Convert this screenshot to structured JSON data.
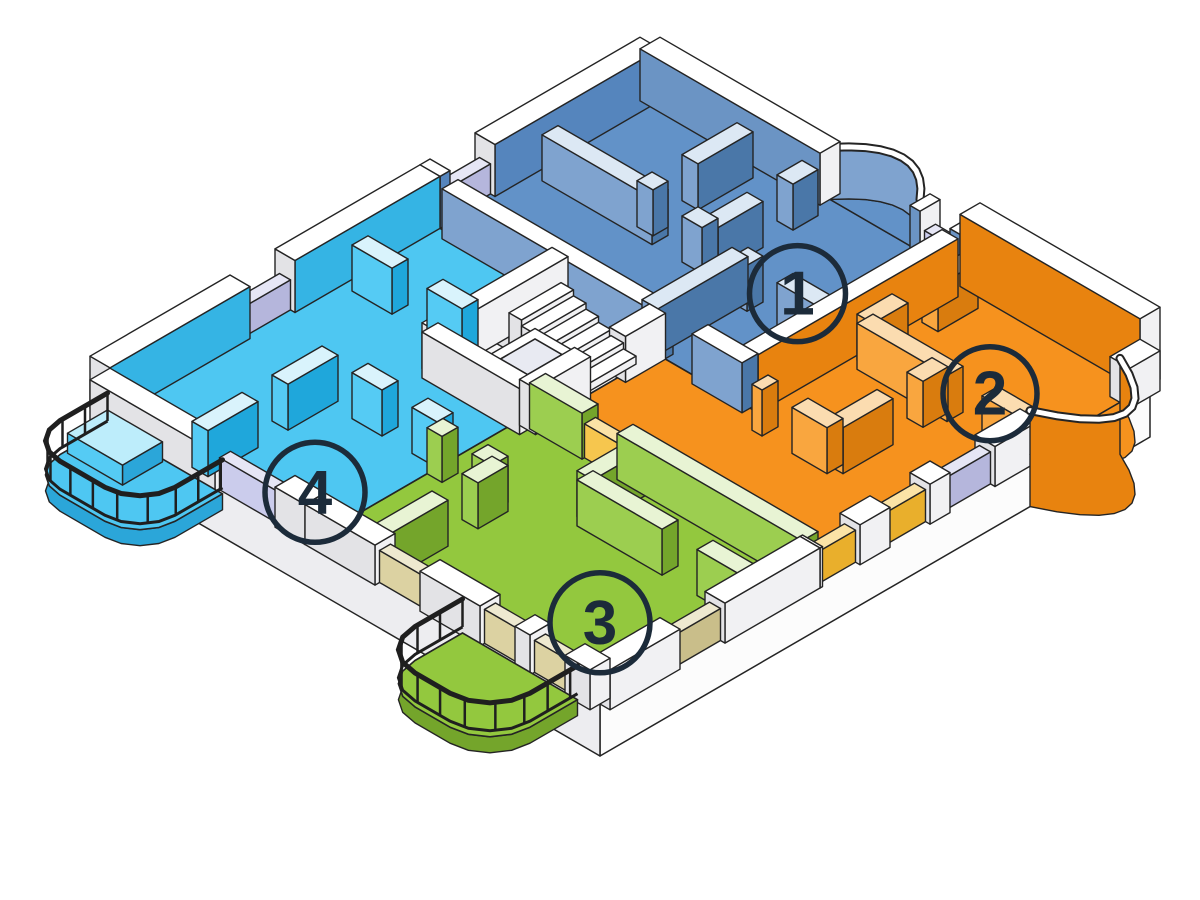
{
  "title": "Isometric cutaway floor plan with four numbered apartments",
  "units": [
    {
      "number": "1",
      "color_hex": "#6292C8",
      "position": "top-center"
    },
    {
      "number": "2",
      "color_hex": "#F6921E",
      "position": "right"
    },
    {
      "number": "3",
      "color_hex": "#93C83E",
      "position": "bottom-center"
    },
    {
      "number": "4",
      "color_hex": "#4EC7F2",
      "position": "left"
    }
  ],
  "colors": {
    "outline": "#242424",
    "background": "#FFFFFF",
    "badge": "#1C2B3A",
    "railing": "#1F1F1F",
    "elevatorInset": "#E8EAF2",
    "slabSide": {
      "se": "#FCFCFC",
      "sw": "#EDEDF0"
    },
    "floors": {
      "blueFloor": "#6292C8",
      "orangeFloor": "#F6921E",
      "greenFloor": "#93C83E",
      "cyanFloor": "#4EC7F2",
      "coreFloor": "#F7F7F8"
    },
    "materials": {
      "white": {
        "top": "#FFFFFF",
        "se": "#F1F1F3",
        "sw": "#E3E3E6"
      },
      "blue": {
        "top": "#DCE8F4",
        "se": "#4A77A8",
        "sw": "#7FA3CF"
      },
      "blueFront": {
        "top": "#FFFFFF",
        "se": "#4A77A8",
        "sw": "#7FA3CF"
      },
      "blueOuterL": {
        "top": "#FFFFFF",
        "se": "#5585BD",
        "sw": "#E3E3E6"
      },
      "blueOuterB": {
        "top": "#FFFFFF",
        "se": "#F1F1F3",
        "sw": "#6B94C4"
      },
      "cyanOuterL": {
        "top": "#FFFFFF",
        "se": "#35B4E4",
        "sw": "#E3E3E6"
      },
      "cyan": {
        "top": "#D9F3FC",
        "se": "#1FA7DB",
        "sw": "#55CBF4"
      },
      "green": {
        "top": "#E8F4D4",
        "se": "#74A52B",
        "sw": "#9CCE50"
      },
      "orange": {
        "top": "#FBDCB0",
        "se": "#D97C0E",
        "sw": "#F9A63F"
      },
      "orangeTall": {
        "top": "#FFFFFF",
        "se": "#E8830F",
        "sw": "#F9A63F"
      },
      "orangeOuterB": {
        "top": "#FFFFFF",
        "se": "#F1F1F3",
        "sw": "#E8830F"
      },
      "lavender": {
        "top": "#E6E6F5",
        "se": "#B5B6DC",
        "sw": "#CBCCEC"
      },
      "tan": {
        "top": "#EEE9D0",
        "se": "#C9BE8A",
        "sw": "#DCD2A2"
      },
      "yellow": {
        "top": "#FBE3A6",
        "se": "#E9AF2C",
        "sw": "#F6C64E"
      },
      "planter": {
        "top": "#BDEDFB",
        "se": "#2BA6D9",
        "sw": "#55CBF4"
      }
    }
  },
  "diagram": {
    "iso": {
      "ox": 650,
      "oy": 95,
      "kx": 50,
      "ky": 29
    },
    "slab": {
      "footprint": [
        [
          0,
          0
        ],
        [
          10,
          0
        ],
        [
          10,
          11
        ],
        [
          0,
          11
        ]
      ],
      "depth": 52
    },
    "floors": [
      {
        "name": "unit-1-floor",
        "color": "blueFloor",
        "poly": [
          [
            0,
            0
          ],
          [
            6.4,
            0
          ],
          [
            6.4,
            4.4
          ],
          [
            0,
            4.4
          ]
        ]
      },
      {
        "name": "unit-2-floor",
        "color": "orangeFloor",
        "poly": [
          [
            6.4,
            0
          ],
          [
            10,
            0
          ],
          [
            10,
            6.8
          ],
          [
            4.55,
            6.8
          ],
          [
            4.55,
            4.4
          ],
          [
            6.4,
            4.4
          ]
        ]
      },
      {
        "name": "unit-3-floor",
        "color": "greenFloor",
        "poly": [
          [
            4.3,
            6.8
          ],
          [
            10,
            6.8
          ],
          [
            10,
            11
          ],
          [
            4.3,
            11
          ]
        ]
      },
      {
        "name": "unit-4-floor",
        "color": "cyanFloor",
        "poly": [
          [
            0,
            4.4
          ],
          [
            2.6,
            4.4
          ],
          [
            2.6,
            7.0
          ],
          [
            4.3,
            7.0
          ],
          [
            4.3,
            11
          ],
          [
            0,
            11
          ]
        ]
      },
      {
        "name": "core-floor",
        "color": "coreFloor",
        "poly": [
          [
            2.6,
            4.4
          ],
          [
            4.55,
            4.4
          ],
          [
            4.55,
            7.0
          ],
          [
            2.6,
            7.0
          ]
        ]
      }
    ],
    "walls": [
      {
        "id": "outer-back-left-blue",
        "a": [
          0,
          0
        ],
        "b": [
          0,
          4.4
        ],
        "t": 0.4,
        "h": 52,
        "mat": "blueOuterL",
        "gaps": [
          [
            3.3,
            4.2
          ]
        ],
        "panels": [
          {
            "s": 3.3,
            "e": 4.2,
            "mat": "lavender",
            "h": 30
          }
        ]
      },
      {
        "id": "outer-back-left-cyan",
        "a": [
          0,
          4.4
        ],
        "b": [
          0,
          11
        ],
        "t": 0.4,
        "h": 52,
        "mat": "cyanOuterL",
        "gaps": [
          [
            2.9,
            3.8
          ]
        ],
        "panels": [
          {
            "s": 2.9,
            "e": 3.8,
            "mat": "lavender",
            "h": 30
          }
        ]
      },
      {
        "id": "outer-back-right-blue",
        "a": [
          0,
          0
        ],
        "b": [
          6.4,
          0
        ],
        "t": 0.4,
        "h": 52,
        "mat": "blueOuterB",
        "gaps": [
          [
            3.6,
            5.4
          ],
          [
            5.6,
            6.2
          ]
        ],
        "panels": [
          {
            "s": 5.6,
            "e": 6.2,
            "mat": "lavender",
            "h": 30
          }
        ]
      },
      {
        "id": "outer-back-right-orange",
        "a": [
          6.4,
          0
        ],
        "b": [
          10,
          0
        ],
        "t": 0.4,
        "h": 72,
        "mat": "orangeOuterB"
      },
      {
        "id": "outer-front-right-orange",
        "a": [
          10,
          0
        ],
        "b": [
          10,
          6.8
        ],
        "t": 0.4,
        "h": 40,
        "mat": "white",
        "gaps": [
          [
            0.6,
            2.4
          ],
          [
            3.3,
            4.2
          ],
          [
            4.6,
            5.4
          ],
          [
            6.0,
            6.75
          ]
        ],
        "panels": [
          {
            "s": 3.3,
            "e": 4.2,
            "mat": "lavender",
            "h": 32
          },
          {
            "s": 4.6,
            "e": 5.4,
            "mat": "yellow",
            "h": 32
          },
          {
            "s": 6.0,
            "e": 6.75,
            "mat": "yellow",
            "h": 32
          }
        ]
      },
      {
        "id": "outer-front-right-green",
        "a": [
          10,
          6.8
        ],
        "b": [
          10,
          11
        ],
        "t": 0.4,
        "h": 40,
        "mat": "white",
        "gaps": [
          [
            1.9,
            2.8
          ]
        ],
        "panels": [
          {
            "s": 1.9,
            "e": 2.8,
            "mat": "tan",
            "h": 32
          }
        ]
      },
      {
        "id": "outer-front-left-cyan",
        "a": [
          0,
          11
        ],
        "b": [
          4.3,
          11
        ],
        "t": 0.4,
        "h": 40,
        "mat": "white",
        "gaps": [
          [
            2.5,
            3.7
          ]
        ],
        "panels": [
          {
            "s": 2.5,
            "e": 3.7,
            "mat": "lavender",
            "h": 32
          }
        ]
      },
      {
        "id": "outer-front-left-green",
        "a": [
          4.3,
          11
        ],
        "b": [
          10,
          11
        ],
        "t": 0.4,
        "h": 40,
        "mat": "white",
        "gaps": [
          [
            1.4,
            2.3
          ],
          [
            3.5,
            4.2
          ],
          [
            4.5,
            5.2
          ]
        ],
        "panels": [
          {
            "s": 1.4,
            "e": 2.3,
            "mat": "tan",
            "h": 32
          },
          {
            "s": 3.5,
            "e": 4.2,
            "mat": "tan",
            "h": 34
          },
          {
            "s": 4.5,
            "e": 5.2,
            "mat": "tan",
            "h": 32
          }
        ]
      },
      {
        "id": "u1-partition-a",
        "a": [
          2.3,
          0.4
        ],
        "b": [
          2.3,
          2.4
        ],
        "mat": "blue",
        "gaps": [
          [
            1.1,
            1.7
          ]
        ]
      },
      {
        "id": "u1-partition-b",
        "a": [
          0.4,
          2.4
        ],
        "b": [
          3.6,
          2.4
        ],
        "mat": "blue",
        "gaps": [
          [
            2.2,
            2.8
          ]
        ]
      },
      {
        "id": "u1-partition-c",
        "a": [
          3.6,
          0.4
        ],
        "b": [
          3.6,
          2.4
        ],
        "mat": "blue",
        "gaps": [
          [
            0.5,
            1.1
          ]
        ]
      },
      {
        "id": "u1-partition-d",
        "a": [
          4.4,
          2.6
        ],
        "b": [
          6.4,
          2.6
        ],
        "mat": "blue",
        "gaps": [
          [
            0.3,
            0.9
          ]
        ]
      },
      {
        "id": "u1-partition-e",
        "a": [
          4.4,
          2.6
        ],
        "b": [
          4.4,
          4.4
        ],
        "mat": "blue"
      },
      {
        "id": "u1-front-wall",
        "a": [
          0.4,
          4.4
        ],
        "b": [
          6.4,
          4.4
        ],
        "mat": "blueFront",
        "h": 50,
        "gaps": [
          [
            4.3,
            5.0
          ]
        ]
      },
      {
        "id": "u1-u2-divider",
        "a": [
          6.4,
          0.4
        ],
        "b": [
          6.4,
          4.4
        ],
        "mat": "orangeTall",
        "h": 58
      },
      {
        "id": "u2-partition-a",
        "a": [
          6.8,
          2.5
        ],
        "b": [
          10,
          2.5
        ],
        "mat": "orange",
        "gaps": [
          [
            1.8,
            2.5
          ]
        ]
      },
      {
        "id": "u2-partition-b",
        "a": [
          8.3,
          2.5
        ],
        "b": [
          8.3,
          4.6
        ],
        "mat": "orange",
        "gaps": [
          [
            0.5,
            1.1
          ]
        ]
      },
      {
        "id": "u2-partition-c",
        "a": [
          6.8,
          4.6
        ],
        "b": [
          8.3,
          4.6
        ],
        "mat": "orange",
        "gaps": [
          [
            0.2,
            0.8
          ]
        ]
      },
      {
        "id": "u2-partition-d",
        "a": [
          6.8,
          0.4
        ],
        "b": [
          6.8,
          2.5
        ],
        "mat": "orange",
        "gaps": [
          [
            0.8,
            1.4
          ]
        ]
      },
      {
        "id": "u2-u3-divider",
        "a": [
          4.55,
          6.8
        ],
        "b": [
          10,
          6.8
        ],
        "mat": "green",
        "gaps": [
          [
            1.05,
            1.75
          ]
        ],
        "panels": [
          {
            "s": 1.05,
            "e": 1.75,
            "mat": "yellow",
            "h": 34
          }
        ]
      },
      {
        "id": "u3-partition-a",
        "a": [
          6.7,
          6.8
        ],
        "b": [
          6.7,
          8.0
        ],
        "mat": "green"
      },
      {
        "id": "u3-partition-b",
        "a": [
          6.7,
          8.0
        ],
        "b": [
          10,
          8.0
        ],
        "mat": "green",
        "gaps": [
          [
            1.7,
            2.4
          ]
        ]
      },
      {
        "id": "u3-partition-c",
        "a": [
          5.6,
          8.6
        ],
        "b": [
          5.6,
          11
        ],
        "mat": "green",
        "gaps": [
          [
            0.6,
            1.2
          ]
        ]
      },
      {
        "id": "u3-partition-d",
        "a": [
          4.3,
          8.6
        ],
        "b": [
          5.6,
          8.6
        ],
        "mat": "green",
        "gaps": [
          [
            0.3,
            0.9
          ]
        ]
      },
      {
        "id": "u4-partition-a",
        "a": [
          0.4,
          6.2
        ],
        "b": [
          2.6,
          6.2
        ],
        "mat": "cyan",
        "gaps": [
          [
            0.8,
            1.5
          ]
        ]
      },
      {
        "id": "u4-partition-b",
        "a": [
          2.6,
          8.4
        ],
        "b": [
          4.3,
          8.4
        ],
        "mat": "cyan",
        "gaps": [
          [
            0.6,
            1.2
          ]
        ]
      },
      {
        "id": "u4-partition-c",
        "a": [
          2.0,
          8.4
        ],
        "b": [
          2.0,
          11
        ],
        "mat": "cyan",
        "gaps": [
          [
            1.0,
            1.6
          ]
        ]
      },
      {
        "id": "core-wall-left",
        "a": [
          2.6,
          4.4
        ],
        "b": [
          2.6,
          7.0
        ],
        "mat": "white"
      },
      {
        "id": "core-wall-front",
        "a": [
          2.6,
          7.0
        ],
        "b": [
          4.55,
          7.0
        ],
        "mat": "white"
      },
      {
        "id": "core-wall-right",
        "a": [
          4.55,
          4.4
        ],
        "b": [
          4.55,
          7.0
        ],
        "mat": "white",
        "gaps": [
          [
            0.8,
            1.5
          ]
        ]
      }
    ],
    "stairs": {
      "x": 2.75,
      "y0": 4.78,
      "y1": 5.82,
      "step": 0.25,
      "count": 7,
      "h0": 44,
      "dh": 6
    },
    "elevator": {
      "box": [
        3.6,
        5.9,
        4.5,
        6.95
      ],
      "h": 42,
      "inset": [
        3.78,
        6.08,
        4.32,
        6.77
      ],
      "kadj": -0.4
    },
    "bays": [
      {
        "name": "unit-1-bay",
        "layer": "back",
        "a": [
          3.6,
          0
        ],
        "b": [
          5.4,
          0
        ],
        "ctrl": [
          4.5,
          -1.1
        ],
        "h": 52,
        "z0": 0,
        "face": "#7FA3CF",
        "floor": "blueFloor"
      },
      {
        "name": "unit-2-bay",
        "layer": "front",
        "a": [
          10,
          0.6
        ],
        "b": [
          10,
          2.4
        ],
        "ctrl": [
          12,
          1.5
        ],
        "h": 44,
        "z0": -52,
        "face": "#E8830F",
        "floor": "orangeFloor"
      }
    ],
    "balconies": [
      {
        "name": "unit-4-balcony",
        "x0": 0.3,
        "x1": 2.6,
        "y0": 11.15,
        "y1": 12.8,
        "r": 0.7,
        "floor": "cyanFloor",
        "fascia": "#2BA6D9",
        "planter": [
          0.35,
          11.2,
          1.45,
          12.0,
          20
        ]
      },
      {
        "name": "unit-3-balcony",
        "x0": 7.4,
        "x1": 9.7,
        "y0": 11.15,
        "y1": 12.9,
        "r": 0.8,
        "floor": "greenFloor",
        "fascia": "#74A52B"
      }
    ],
    "badges": [
      {
        "label": "1",
        "x": 4.9,
        "y": 1.95,
        "r": 48
      },
      {
        "label": "2",
        "x": 8.55,
        "y": 1.75,
        "r": 47
      },
      {
        "label": "3",
        "x": 8.6,
        "y": 9.6,
        "r": 50
      },
      {
        "label": "4",
        "x": 3.5,
        "y": 10.2,
        "r": 50
      }
    ]
  }
}
